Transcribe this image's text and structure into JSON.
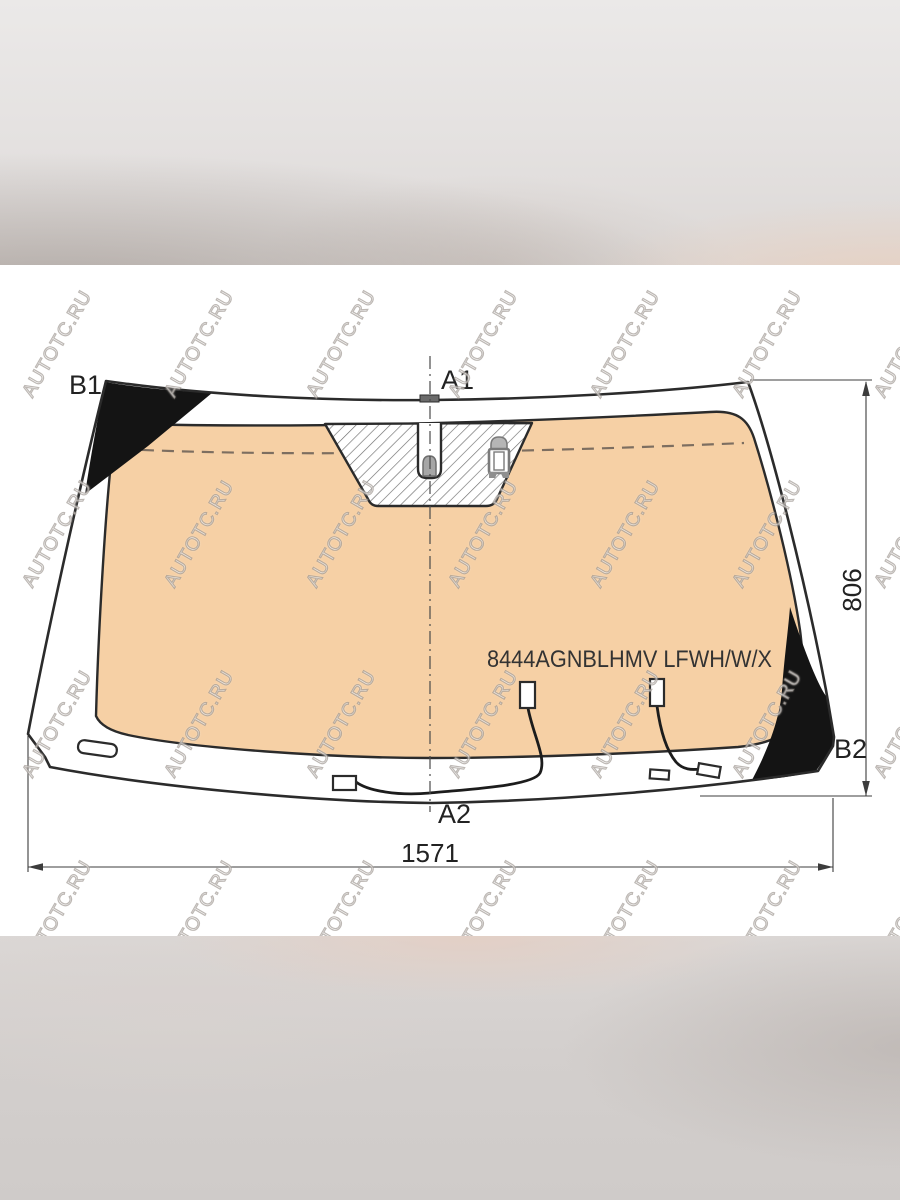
{
  "diagram": {
    "part_number": "8444AGNBLHMV LFWH/W/X",
    "labels": {
      "top_center": "A1",
      "bottom_center": "A2",
      "top_left": "B1",
      "right": "B2"
    },
    "dimensions": {
      "width_mm": "1571",
      "height_mm": "806"
    },
    "watermark": {
      "text": "AUTOTC.RU"
    },
    "colors": {
      "glass_tint": "#f6d0a5",
      "outline": "#2b2b2b",
      "shade_patch": "#141414",
      "dimension": "#3c3c3c",
      "ceramic_dash": "#7d6e60"
    },
    "icons": {
      "mirror_button": "mirror-mount-button",
      "rain_sensor": "rain-sensor-bracket",
      "hatch_area": "sensor-hatch-zone"
    }
  }
}
